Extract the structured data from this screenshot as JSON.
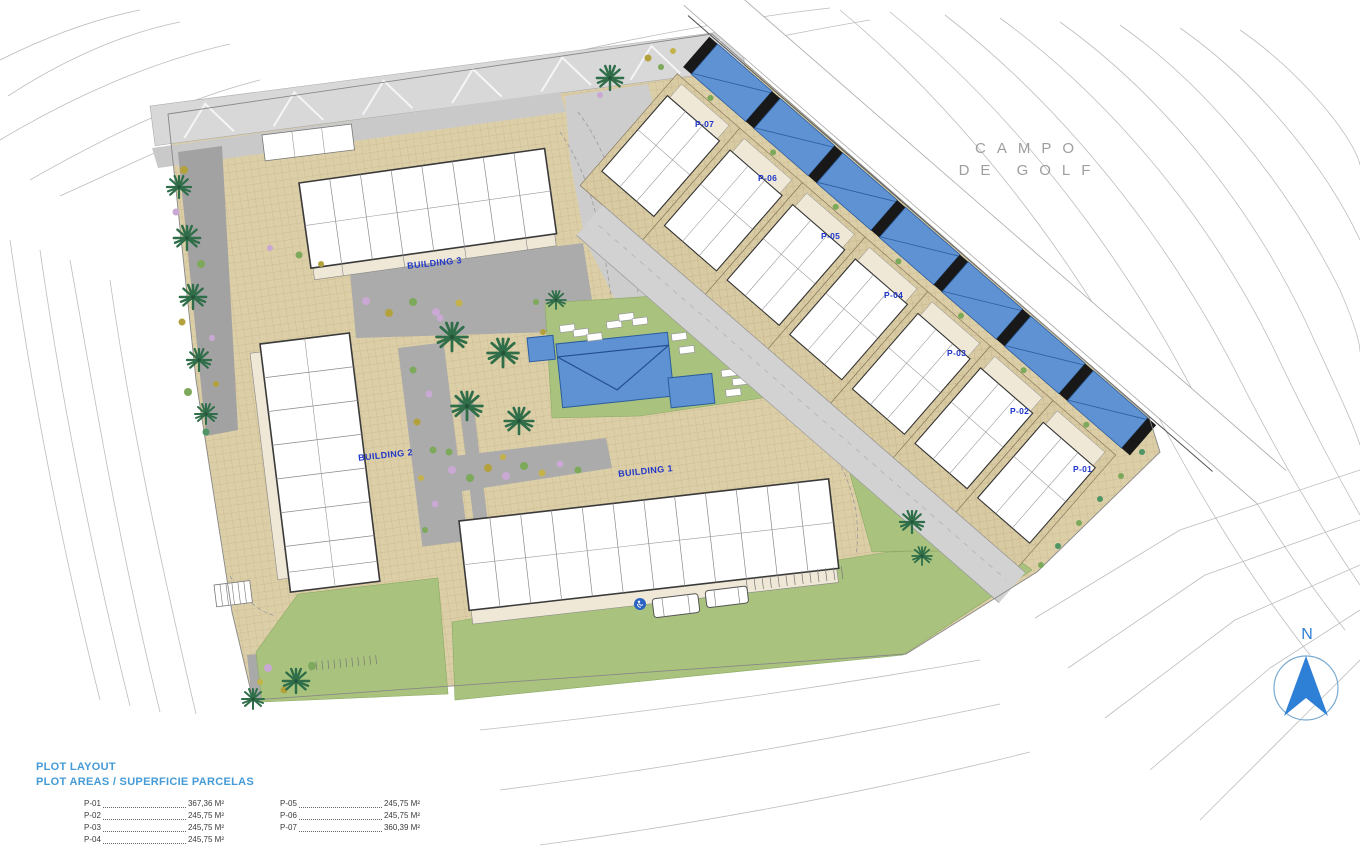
{
  "plan": {
    "area_label": {
      "line1": "CAMPO",
      "line2": "DE GOLF"
    },
    "north": "N",
    "buildings": [
      {
        "label": "BUILDING 1"
      },
      {
        "label": "BUILDING 2"
      },
      {
        "label": "BUILDING 3"
      }
    ],
    "plots": [
      {
        "label": "P-01"
      },
      {
        "label": "P-02"
      },
      {
        "label": "P-03"
      },
      {
        "label": "P-04"
      },
      {
        "label": "P-05"
      },
      {
        "label": "P-06"
      },
      {
        "label": "P-07"
      }
    ]
  },
  "legend": {
    "title": "PLOT LAYOUT",
    "subtitle": "PLOT AREAS / SUPERFICIE PARCELAS",
    "entries": [
      {
        "plot": "P-01",
        "area": "367,36 M²"
      },
      {
        "plot": "P-02",
        "area": "245,75 M²"
      },
      {
        "plot": "P-03",
        "area": "245,75 M²"
      },
      {
        "plot": "P-04",
        "area": "245,75 M²"
      },
      {
        "plot": "P-05",
        "area": "245,75 M²"
      },
      {
        "plot": "P-06",
        "area": "245,75 M²"
      },
      {
        "plot": "P-07",
        "area": "360,39 M²"
      }
    ]
  },
  "colors": {
    "paving": "#dccfa8",
    "lawn": "#a9c37e",
    "pool": "#5f92d3",
    "road": "#d6d6d6",
    "courtyard": "#ababab",
    "label_blue": "#2036c8",
    "legend_blue": "#459bd6",
    "north_blue": "#2e7fd6",
    "contour": "#bdbdbd"
  }
}
